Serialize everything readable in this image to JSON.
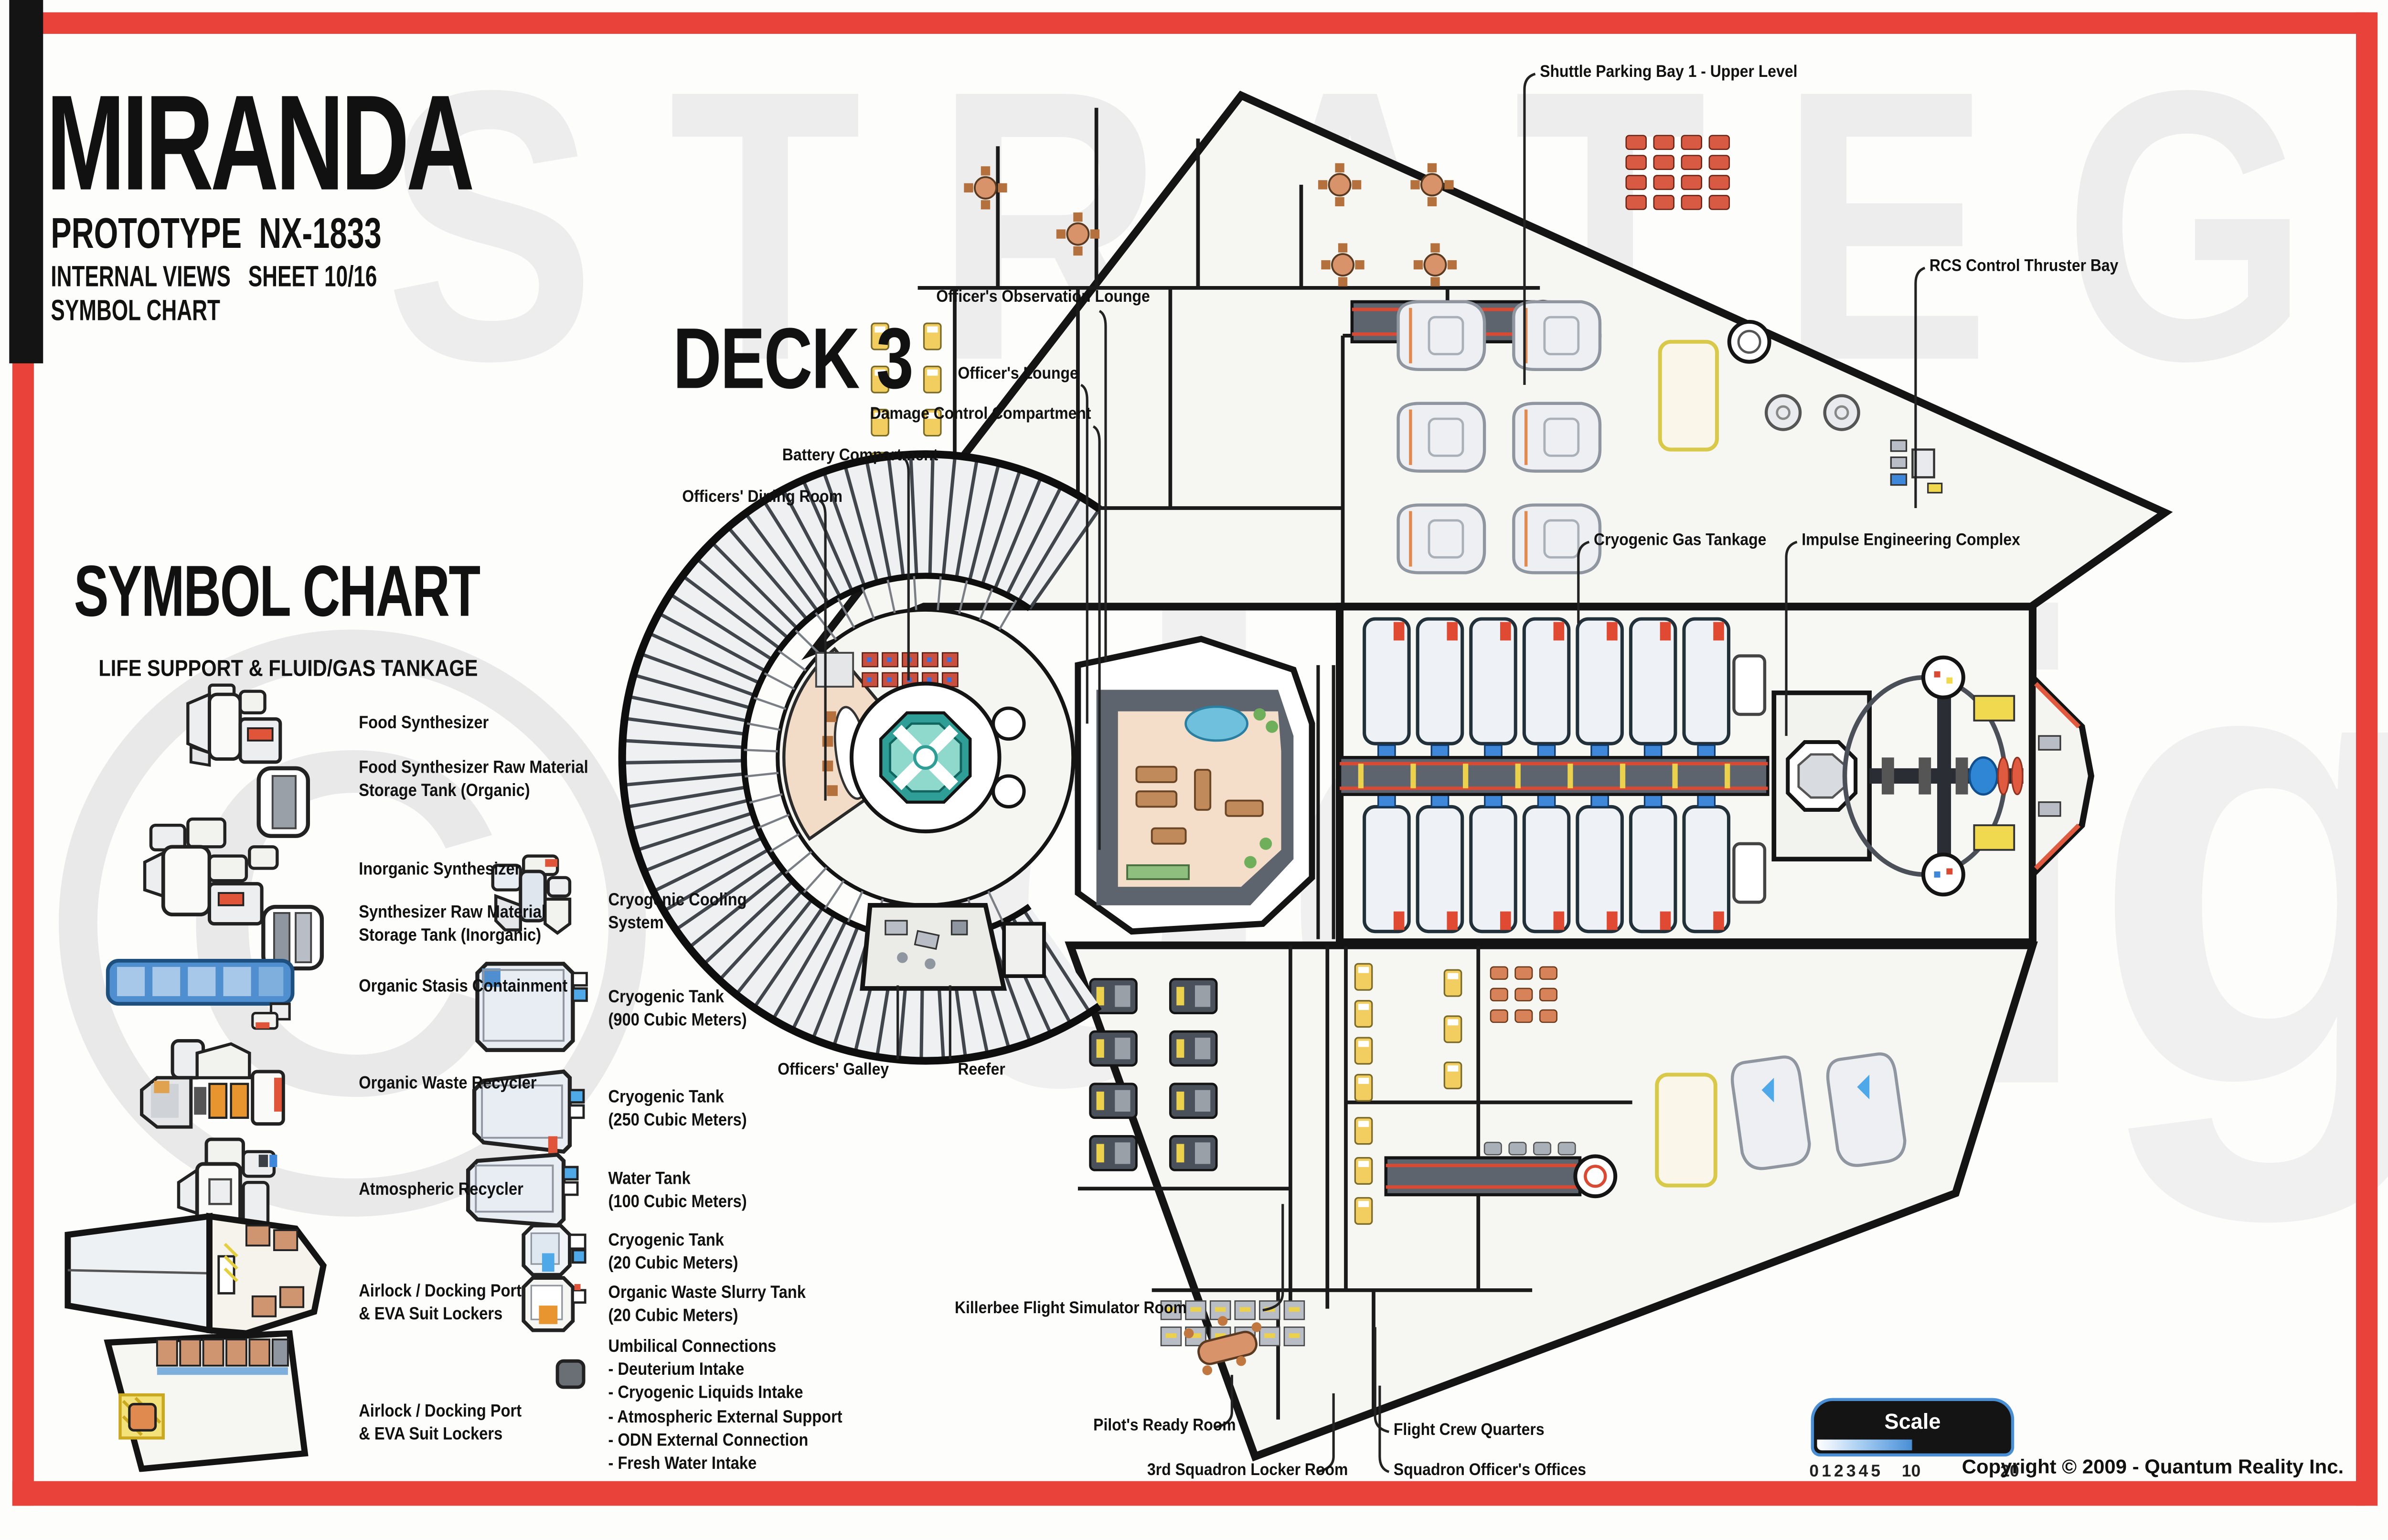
{
  "title_block": {
    "ship_name": "MIRANDA",
    "subtitle": "PROTOTYPE  NX-1833",
    "views_line": "INTERNAL VIEWS   SHEET 10/16",
    "chart_line": "SYMBOL CHART"
  },
  "deck_heading": "DECK 3",
  "legend": {
    "heading": "SYMBOL CHART",
    "subheading": "LIFE SUPPORT & FLUID/GAS TANKAGE",
    "col1": [
      {
        "icon": "food-synthesizer",
        "label": "Food Synthesizer"
      },
      {
        "icon": "food-synthesizer-raw-tank",
        "label": "Food Synthesizer Raw Material\nStorage Tank  (Organic)"
      },
      {
        "icon": "inorganic-synthesizer",
        "label": "Inorganic Synthesizer"
      },
      {
        "icon": "synthesizer-raw-tank",
        "label": "Synthesizer Raw Material\nStorage Tank  (Inorganic)"
      },
      {
        "icon": "organic-stasis",
        "label": "Organic Stasis Containment"
      },
      {
        "icon": "organic-waste-recycler",
        "label": "Organic Waste Recycler"
      },
      {
        "icon": "atmospheric-recycler",
        "label": "Atmospheric Recycler"
      },
      {
        "icon": "airlock-docking-1",
        "label": "Airlock / Docking Port\n& EVA Suit Lockers"
      },
      {
        "icon": "airlock-docking-2",
        "label": "Airlock / Docking Port\n& EVA Suit Lockers"
      }
    ],
    "col2": [
      {
        "icon": "cryogenic-cooling",
        "label": "Cryogenic Cooling\nSystem"
      },
      {
        "icon": "cryo-tank-900",
        "label": "Cryogenic Tank\n(900 Cubic Meters)"
      },
      {
        "icon": "cryo-tank-250",
        "label": "Cryogenic Tank\n(250 Cubic Meters)"
      },
      {
        "icon": "water-tank-100",
        "label": "Water Tank\n(100 Cubic Meters)"
      },
      {
        "icon": "cryo-tank-20",
        "label": "Cryogenic Tank\n(20 Cubic Meters)"
      },
      {
        "icon": "waste-slurry-tank",
        "label": "Organic Waste Slurry Tank\n(20 Cubic Meters)"
      },
      {
        "icon": "umbilical",
        "label": "Umbilical Connections\n- Deuterium Intake\n- Cryogenic Liquids Intake\n- Atmospheric External Support\n- ODN External Connection\n- Fresh Water Intake"
      }
    ]
  },
  "callouts": {
    "shuttle_bay": "Shuttle Parking Bay 1 - Upper Level",
    "rcs": "RCS Control Thruster Bay",
    "observation_lounge": "Officer's Observation Lounge",
    "officers_lounge": "Officer's Lounge",
    "damage_control": "Damage Control Compartment",
    "battery": "Battery Compartment",
    "dining_room": "Officers' Dining Room",
    "cryo_gas": "Cryogenic Gas Tankage",
    "impulse": "Impulse Engineering Complex",
    "galley": "Officers' Galley",
    "reefer": "Reefer",
    "killerbee": "Killerbee Flight Simulator Room",
    "ready_room": "Pilot's Ready Room",
    "locker_room": "3rd Squadron Locker Room",
    "flight_crew": "Flight Crew Quarters",
    "squadron_offices": "Squadron Officer's Offices"
  },
  "scale_bar": {
    "label": "Scale",
    "ticks": [
      "0",
      "1",
      "2",
      "3",
      "4",
      "5",
      "10",
      "20"
    ]
  },
  "copyright": "Copyright © 2009 - Quantum Reality Inc.",
  "watermark": {
    "word1": "STRATEGIC",
    "word2": "design",
    "symbol": "©"
  },
  "colors": {
    "frame_red": "#e8423a",
    "hull_black": "#141414",
    "scalebar_blue": "#4a8fd4",
    "stasis_tank_blue": "#4f8fd0",
    "tank_connector_blue": "#3f87d8",
    "alert_red": "#e05038",
    "bed_yellow": "#f2cd5f",
    "slurry_orange": "#e8952f",
    "floor_peach": "#f3dcc7",
    "core_teal": "#8fd8cc",
    "watermark_gray": "#ececec"
  }
}
